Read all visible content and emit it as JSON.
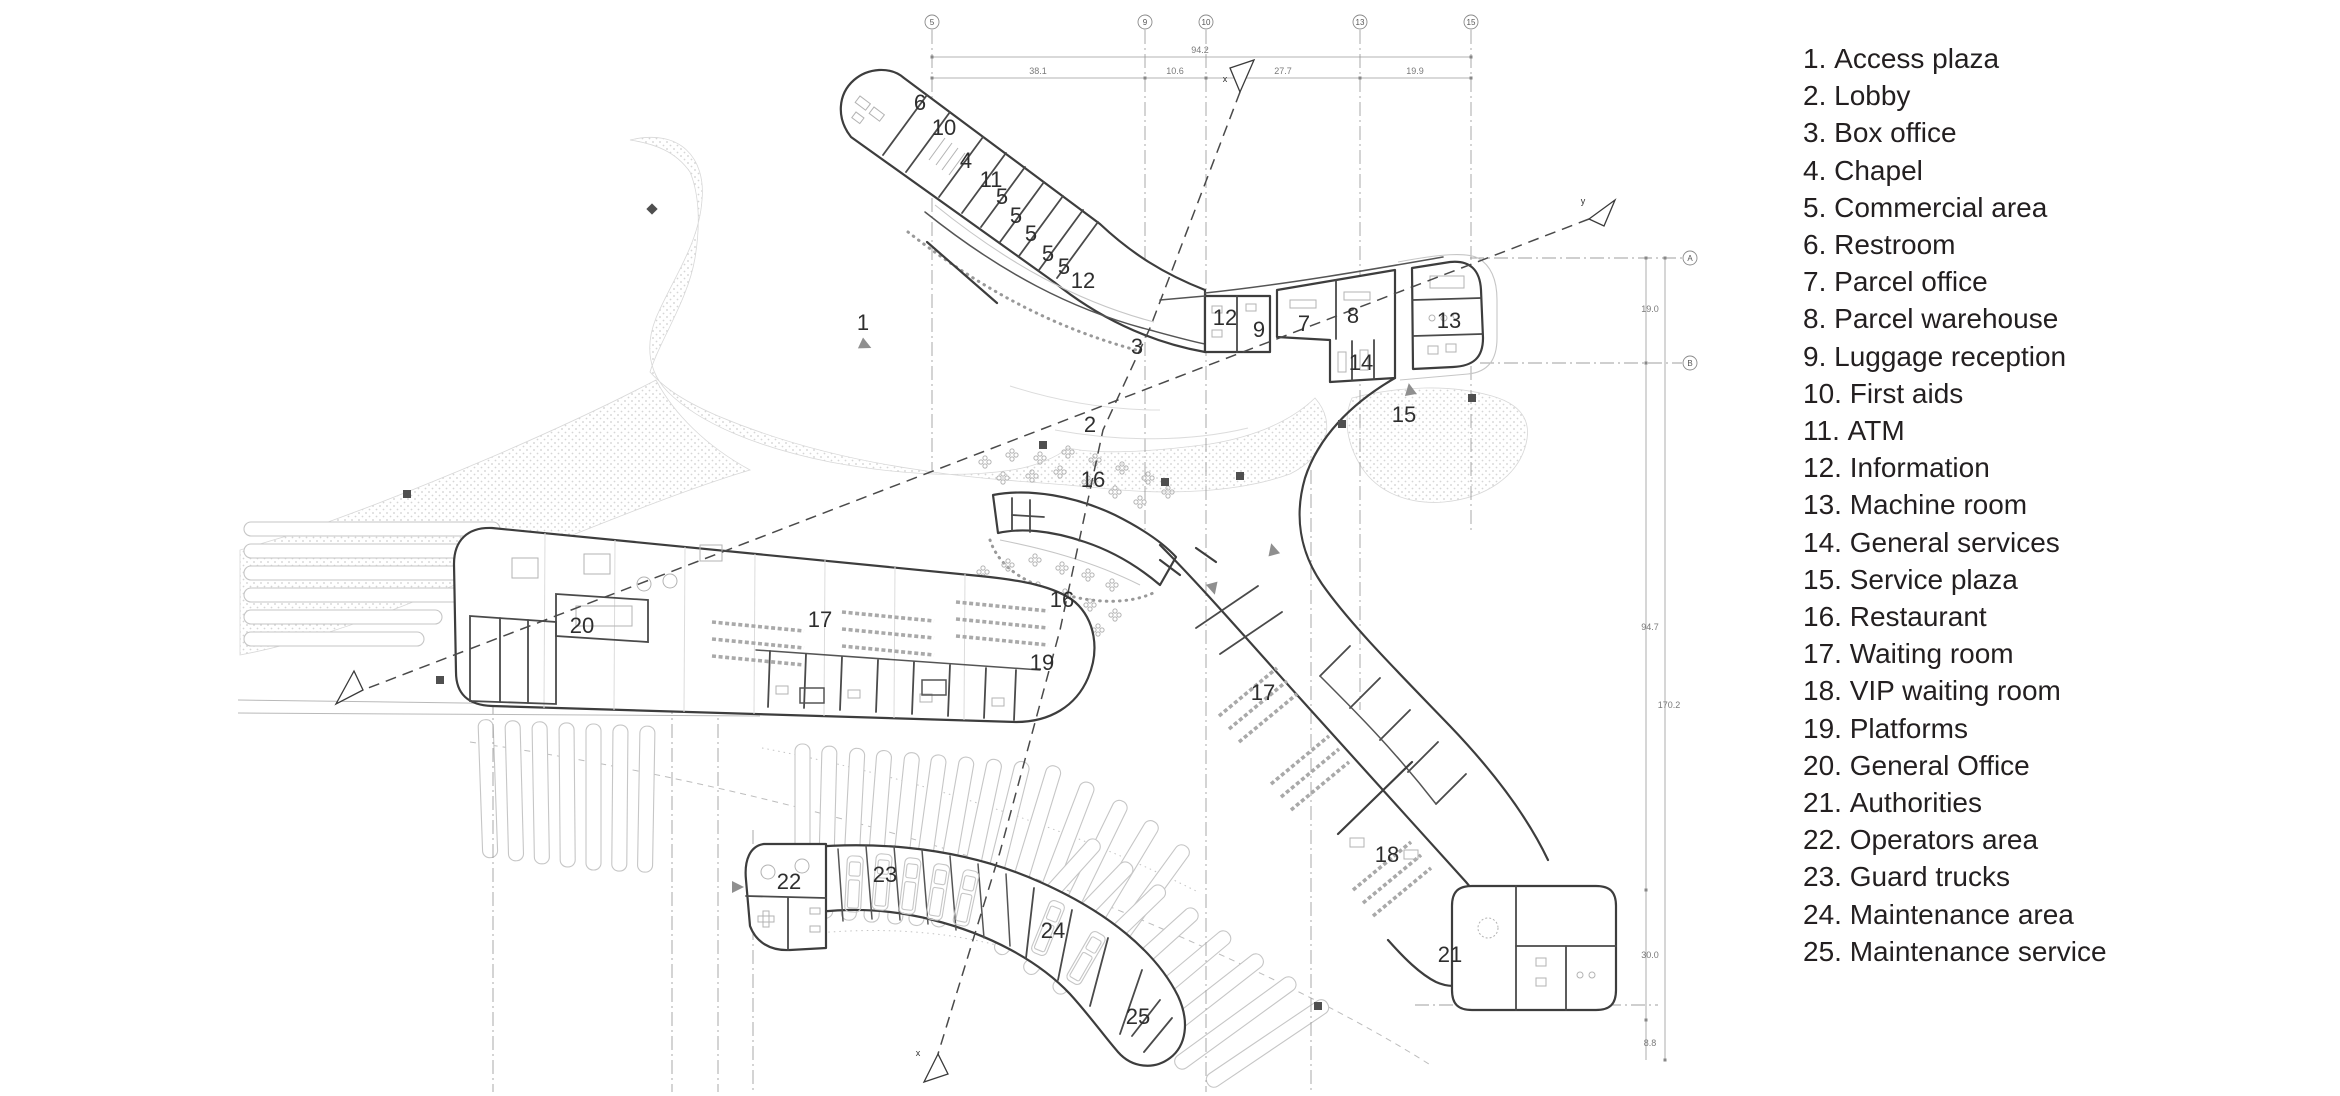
{
  "legend": {
    "items": [
      {
        "num": "1.",
        "label": "Access plaza"
      },
      {
        "num": "2.",
        "label": "Lobby"
      },
      {
        "num": "3.",
        "label": "Box office"
      },
      {
        "num": "4.",
        "label": "Chapel"
      },
      {
        "num": "5.",
        "label": "Commercial area"
      },
      {
        "num": "6.",
        "label": "Restroom"
      },
      {
        "num": "7.",
        "label": "Parcel office"
      },
      {
        "num": "8.",
        "label": "Parcel warehouse"
      },
      {
        "num": "9.",
        "label": "Luggage reception"
      },
      {
        "num": "10.",
        "label": "First aids"
      },
      {
        "num": "11.",
        "label": "ATM"
      },
      {
        "num": "12.",
        "label": "Information"
      },
      {
        "num": "13.",
        "label": "Machine room"
      },
      {
        "num": "14.",
        "label": "General services"
      },
      {
        "num": "15.",
        "label": "Service plaza"
      },
      {
        "num": "16.",
        "label": "Restaurant"
      },
      {
        "num": "17.",
        "label": "Waiting room"
      },
      {
        "num": "18.",
        "label": "VIP waiting room"
      },
      {
        "num": "19.",
        "label": "Platforms"
      },
      {
        "num": "20.",
        "label": "General Office"
      },
      {
        "num": "21.",
        "label": "Authorities"
      },
      {
        "num": "22.",
        "label": "Operators area"
      },
      {
        "num": "23.",
        "label": "Guard trucks"
      },
      {
        "num": "24.",
        "label": "Maintenance area"
      },
      {
        "num": "25.",
        "label": "Maintenance service"
      }
    ]
  },
  "plan": {
    "room_labels": [
      {
        "n": "1",
        "x": 863,
        "y": 330
      },
      {
        "n": "2",
        "x": 1090,
        "y": 432
      },
      {
        "n": "3",
        "x": 1137,
        "y": 354
      },
      {
        "n": "4",
        "x": 966,
        "y": 168
      },
      {
        "n": "5",
        "x": 1002,
        "y": 204
      },
      {
        "n": "5",
        "x": 1016,
        "y": 223
      },
      {
        "n": "5",
        "x": 1031,
        "y": 241
      },
      {
        "n": "5",
        "x": 1048,
        "y": 261
      },
      {
        "n": "5",
        "x": 1064,
        "y": 274
      },
      {
        "n": "6",
        "x": 920,
        "y": 110
      },
      {
        "n": "7",
        "x": 1304,
        "y": 331
      },
      {
        "n": "8",
        "x": 1353,
        "y": 323
      },
      {
        "n": "9",
        "x": 1259,
        "y": 337
      },
      {
        "n": "10",
        "x": 944,
        "y": 135
      },
      {
        "n": "11",
        "x": 991,
        "y": 187
      },
      {
        "n": "12",
        "x": 1083,
        "y": 288
      },
      {
        "n": "12",
        "x": 1225,
        "y": 325
      },
      {
        "n": "13",
        "x": 1449,
        "y": 328
      },
      {
        "n": "14",
        "x": 1361,
        "y": 370
      },
      {
        "n": "15",
        "x": 1404,
        "y": 422
      },
      {
        "n": "16",
        "x": 1093,
        "y": 487
      },
      {
        "n": "16",
        "x": 1062,
        "y": 607
      },
      {
        "n": "17",
        "x": 820,
        "y": 627
      },
      {
        "n": "17",
        "x": 1263,
        "y": 700
      },
      {
        "n": "18",
        "x": 1387,
        "y": 862
      },
      {
        "n": "19",
        "x": 1042,
        "y": 670
      },
      {
        "n": "20",
        "x": 582,
        "y": 633
      },
      {
        "n": "21",
        "x": 1450,
        "y": 962
      },
      {
        "n": "22",
        "x": 789,
        "y": 889
      },
      {
        "n": "23",
        "x": 885,
        "y": 882
      },
      {
        "n": "24",
        "x": 1053,
        "y": 938
      },
      {
        "n": "25",
        "x": 1138,
        "y": 1024
      }
    ],
    "grid_top": {
      "bubble_y": 22,
      "bubbles": [
        {
          "label": "5",
          "x": 932
        },
        {
          "label": "9",
          "x": 1145
        },
        {
          "label": "10",
          "x": 1206
        },
        {
          "label": "13",
          "x": 1360
        },
        {
          "label": "15",
          "x": 1471
        }
      ]
    },
    "grid_right": {
      "bubble_x": 1690,
      "bubbles": [
        {
          "label": "A",
          "y": 258
        },
        {
          "label": "B",
          "y": 363
        }
      ]
    },
    "dim_top": {
      "overall": {
        "v": "94.2",
        "x": 1200,
        "y": 53
      },
      "seg_y": 74,
      "segments": [
        {
          "v": "38.1",
          "x": 1038
        },
        {
          "v": "10.6",
          "x": 1175
        },
        {
          "v": "27.7",
          "x": 1283
        },
        {
          "v": "19.9",
          "x": 1415
        }
      ]
    },
    "dim_right": [
      {
        "v": "19.0",
        "x": 1650,
        "y": 312
      },
      {
        "v": "94.7",
        "x": 1650,
        "y": 630
      },
      {
        "v": "170.2",
        "x": 1669,
        "y": 708
      },
      {
        "v": "30.0",
        "x": 1650,
        "y": 958
      },
      {
        "v": "8.8",
        "x": 1650,
        "y": 1046
      }
    ],
    "section_labels": [
      {
        "label": "x",
        "x": 1225,
        "y": 82
      },
      {
        "label": "x",
        "x": 918,
        "y": 1056
      },
      {
        "label": "y",
        "x": 1583,
        "y": 204
      }
    ],
    "colors": {
      "wall": "#3d3d3d",
      "light_line": "#c6c6c6",
      "stipple_dot": "#cfcfcf",
      "label": "#2e2e2e",
      "section_dash": "#4a4a4a"
    }
  }
}
